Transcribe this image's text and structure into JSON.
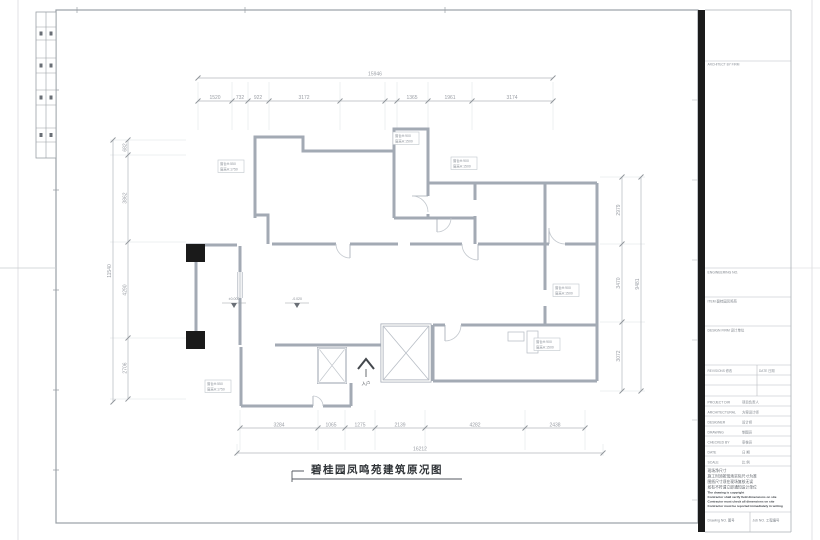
{
  "sheet": {
    "drawing_title": "碧桂园凤鸣苑建筑原况图"
  },
  "dimensions": {
    "top": {
      "overall": "15946",
      "segments": [
        "1520",
        "732",
        "922",
        "3172",
        "1365",
        "1961",
        "3174"
      ]
    },
    "bottom": {
      "overall": "16212",
      "segments": [
        "3284",
        "1065",
        "1275",
        "2139",
        "4282",
        "2438"
      ]
    },
    "left": {
      "overall": "11540",
      "segments": [
        "682",
        "3862",
        "4290",
        "2706"
      ]
    },
    "right": {
      "overall": "9481",
      "segments": [
        "2979",
        "3470",
        "3072"
      ]
    }
  },
  "plan": {
    "entry_label": "入户",
    "level_markers": [
      "±0.000",
      "-0.020"
    ],
    "window_tags": [
      {
        "l1": "窗台H:550",
        "l2": "窗高H:1750"
      },
      {
        "l1": "窗台H:900",
        "l2": "窗高H:1500"
      },
      {
        "l1": "窗台H:900",
        "l2": "窗高H:1500"
      },
      {
        "l1": "窗台H:900",
        "l2": "窗高H:1500"
      },
      {
        "l1": "窗台H:900",
        "l2": "窗高H:1500"
      },
      {
        "l1": "窗台H:550",
        "l2": "窗高H:1750"
      }
    ]
  },
  "title_block": {
    "architect_by": "ARCHITECT BY FIRM",
    "engineering_no_label": "ENGINEERING NO.",
    "item_label": "ITEM  碧桂园凤鸣苑",
    "design_firm_label": "DESIGN FIRM  设计单位",
    "revisions_label": "REVISIONS 修改",
    "rev_date_label": "DATE 日期",
    "rows": [
      {
        "en": "PROJECT DIR",
        "zh": "项目负责人"
      },
      {
        "en": "ARCHITECTURAL",
        "zh": "方案设计师"
      },
      {
        "en": "DESIGNER",
        "zh": "设计师"
      },
      {
        "en": "DRAWING",
        "zh": "制图员"
      },
      {
        "en": "CHECKED BY",
        "zh": "审核员"
      },
      {
        "en": "DATE",
        "zh": "日 期"
      },
      {
        "en": "SCALE",
        "zh": "比 例"
      }
    ],
    "notes": [
      "现场净尺寸",
      "施工时须按现场实际尺寸为准",
      "图纸尺寸须在现场复核无误",
      "如有不符请立即通知设计单位",
      "The drawing is copyright",
      "Contractor shall verify field dimensions on site",
      "Contractor must check all dimensions on site",
      "Contractor must be reported immediately in writing"
    ],
    "drawing_no_label": "Drawing NO. 图号",
    "job_no_label": "Job NO. 工程编号"
  },
  "colors": {
    "wall": "#a3aab4",
    "dim_text": "#9a9ea5",
    "frame": "#9aa0a6",
    "bar": "#1b1b1b",
    "title_text": "#2f3337"
  }
}
